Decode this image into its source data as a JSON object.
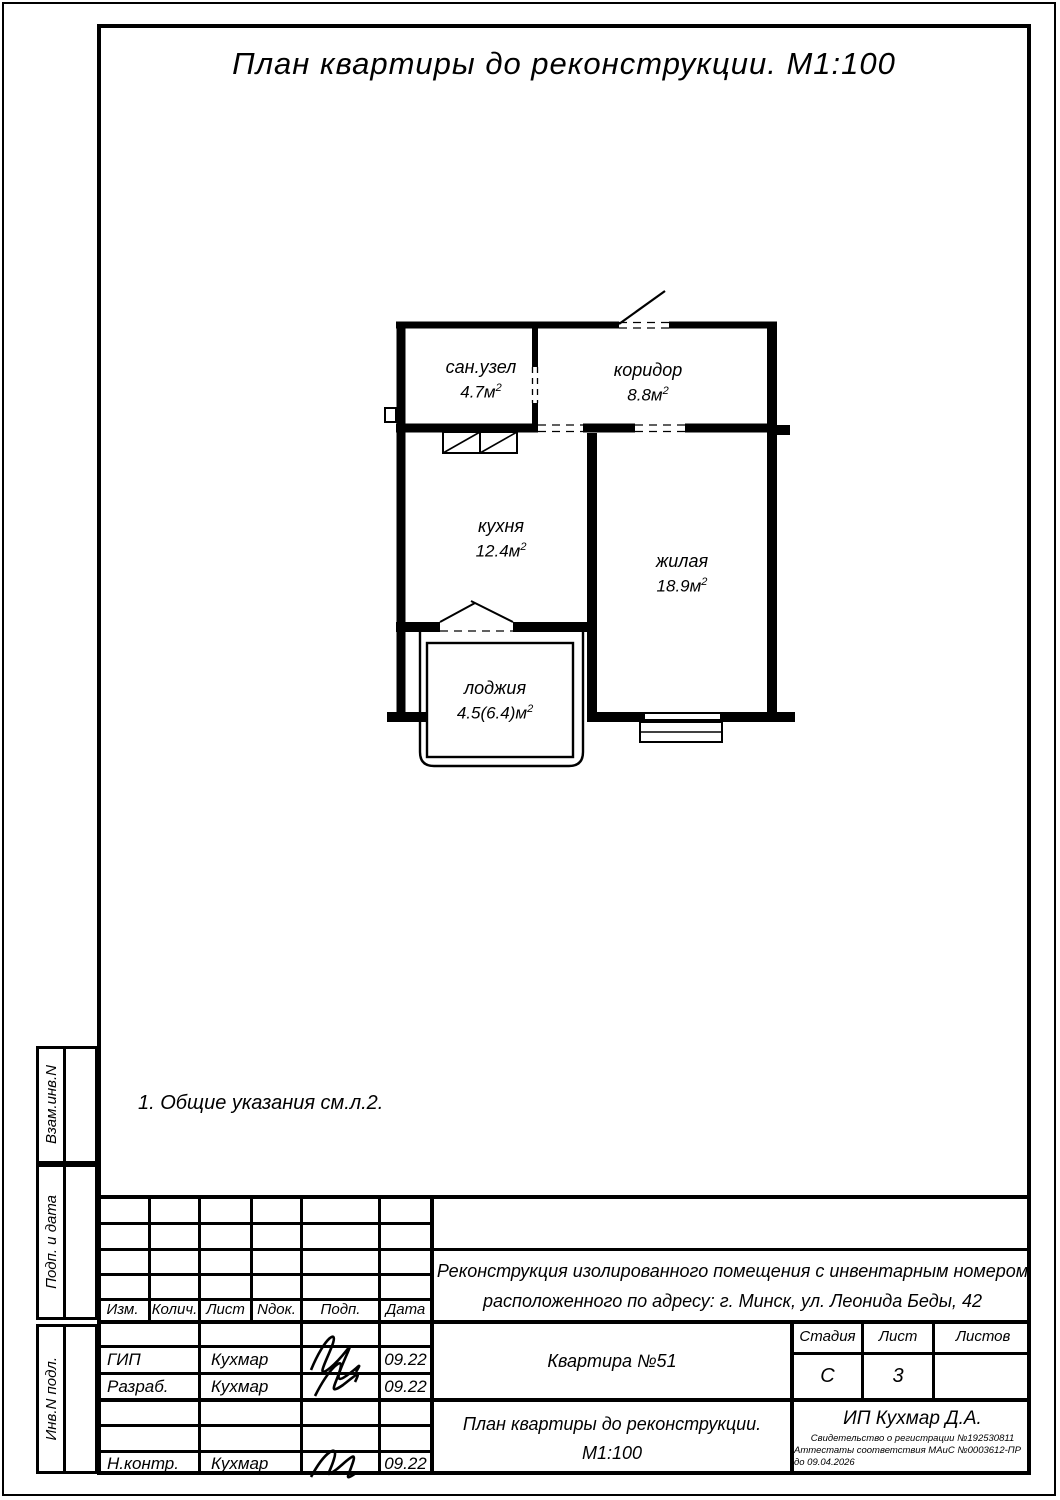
{
  "drawing": {
    "title": "План квартиры до реконструкции. М1:100",
    "note": "1. Общие указания см.л.2.",
    "sup": "2",
    "rooms": {
      "sanuzel": {
        "name": "сан.узел",
        "area": "4.7м"
      },
      "koridor": {
        "name": "коридор",
        "area": "8.8м"
      },
      "kuhnya": {
        "name": "кухня",
        "area": "12.4м"
      },
      "zhilaya": {
        "name": "жилая",
        "area": "18.9м"
      },
      "lodzhiya": {
        "name": "лоджия",
        "area": "4.5(6.4)м"
      }
    }
  },
  "sidebar": {
    "vzam": "Взам.инв.N",
    "podp": "Подп. и дата",
    "inv": "Инв.N подл."
  },
  "titleblock": {
    "header": [
      "Изм.",
      "Колич.",
      "Лист",
      "Nдок.",
      "Подп.",
      "Дата"
    ],
    "rows": [
      {
        "role": "ГИП",
        "name": "Кухмар",
        "date": "09.22"
      },
      {
        "role": "Разраб.",
        "name": "Кухмар",
        "date": "09.22"
      },
      {
        "role": "Н.контр.",
        "name": "Кухмар",
        "date": "09.22"
      }
    ],
    "project_line1": "Реконструкция изолированного помещения с инвентарным номером",
    "project_line2": "расположенного по адресу: г. Минск, ул. Леонида Беды, 42",
    "object": "Квартира №51",
    "stage_label": "Стадия",
    "sheet_label": "Лист",
    "sheets_label": "Листов",
    "stage_value": "С",
    "sheet_value": "3",
    "sheets_value": "",
    "doc_title_line1": "План квартиры до реконструкции.",
    "doc_title_line2": "М1:100",
    "company": "ИП Кухмар Д.А.",
    "cert_line1": "Свидетельство о регистрации №192530811",
    "cert_line2": "Аттестаты соответствия МАиС №0003612-ПР до 09.04.2026"
  }
}
